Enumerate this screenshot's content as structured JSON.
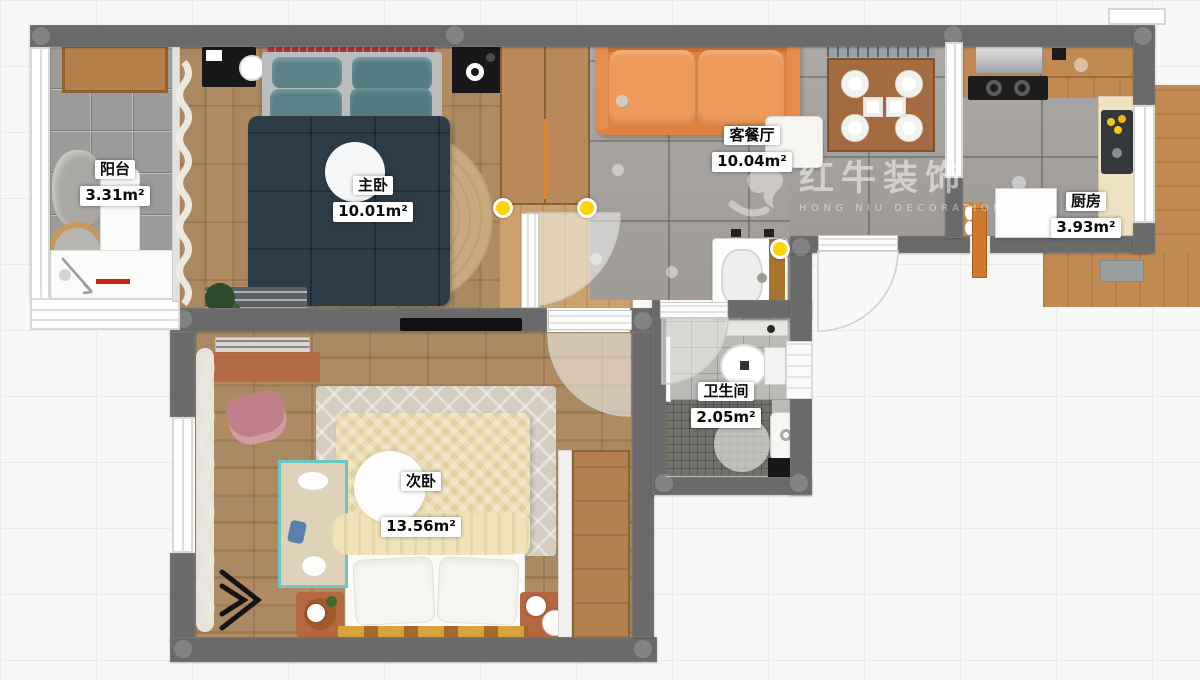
{
  "watermark": {
    "brand": "红牛装饰",
    "subtitle": "HONG NIU DECORATION",
    "registered": "®"
  },
  "rooms": [
    {
      "id": "balcony",
      "name": "阳台",
      "area": "3.31m²"
    },
    {
      "id": "master-bedroom",
      "name": "主卧",
      "area": "10.01m²"
    },
    {
      "id": "living-dining",
      "name": "客餐厅",
      "area": "10.04m²"
    },
    {
      "id": "kitchen",
      "name": "厨房",
      "area": "3.93m²"
    },
    {
      "id": "bathroom",
      "name": "卫生间",
      "area": "2.05m²"
    },
    {
      "id": "second-bedroom",
      "name": "次卧",
      "area": "13.56m²"
    }
  ],
  "colors": {
    "wall": "#6a6a6a",
    "tileLiving": "#a7a3a0",
    "tileBalcony": "#9c9b99",
    "sofaOrange": "#e0813f",
    "bedNavy": "#2e3c47",
    "pillowTeal": "#5b8289",
    "bedCream": "#ecdcb0",
    "rugJute": "#c5a67c",
    "terracotta": "#b5673f",
    "woodCounter": "#c18a52",
    "accentYellow": "#ffd400"
  }
}
